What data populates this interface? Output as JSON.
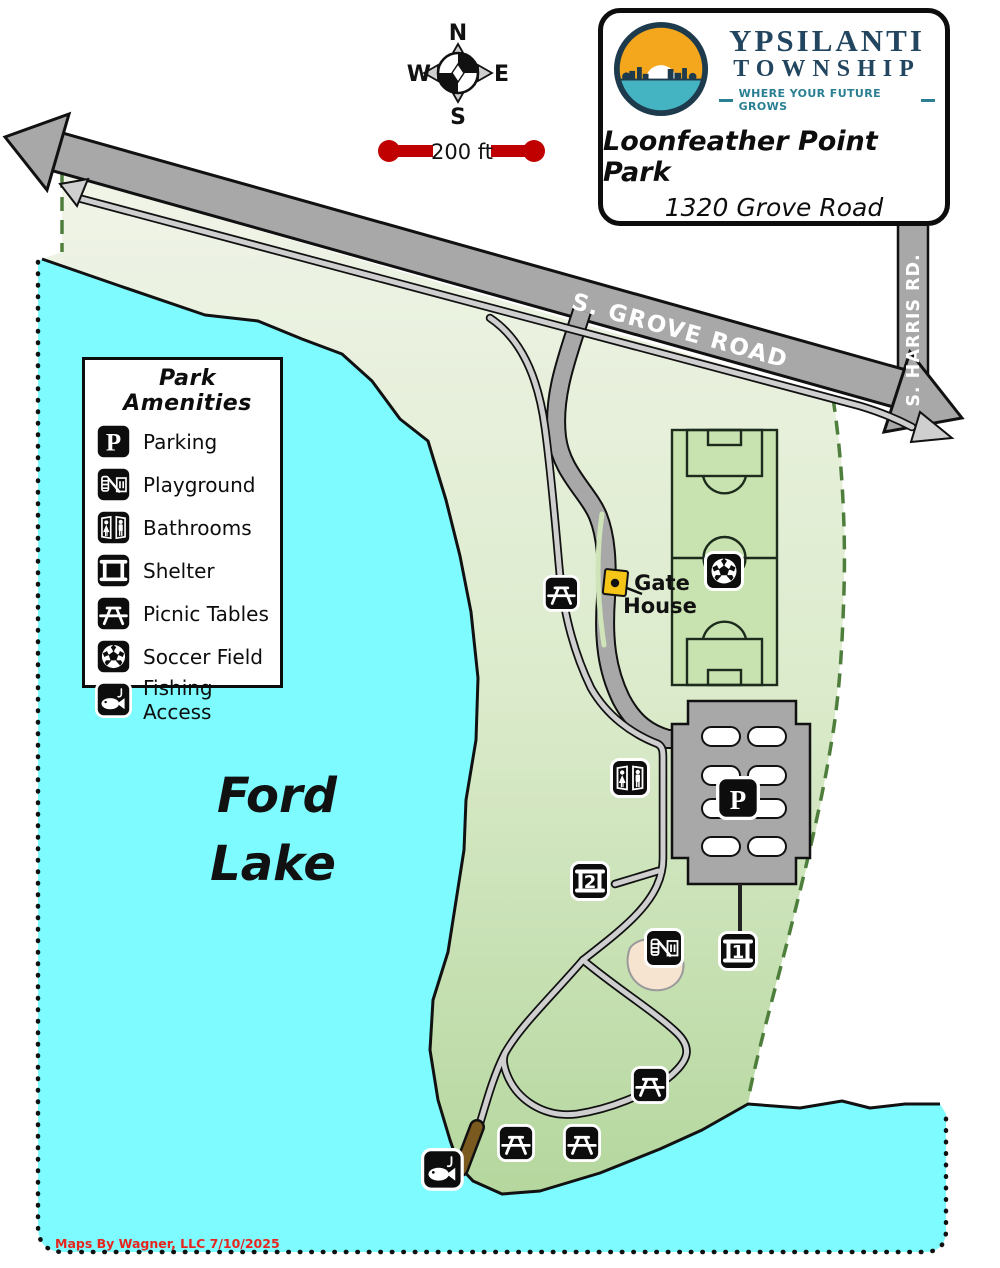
{
  "title_card": {
    "org_line1": "YPSILANTI",
    "org_line2": "TOWNSHIP",
    "tagline": "WHERE YOUR FUTURE GROWS",
    "park_name": "Loonfeather Point Park",
    "address": "1320 Grove Road"
  },
  "compass": {
    "n": "N",
    "s": "S",
    "e": "E",
    "w": "W"
  },
  "scale": {
    "label": "200 ft"
  },
  "legend": {
    "title": "Park Amenities",
    "items": [
      {
        "icon": "parking-icon",
        "label": "Parking"
      },
      {
        "icon": "playground-icon",
        "label": "Playground"
      },
      {
        "icon": "bathrooms-icon",
        "label": "Bathrooms"
      },
      {
        "icon": "shelter-icon",
        "label": "Shelter"
      },
      {
        "icon": "picnic-icon",
        "label": "Picnic Tables"
      },
      {
        "icon": "soccer-icon",
        "label": "Soccer Field"
      },
      {
        "icon": "fishing-icon",
        "label": "Fishing Access"
      }
    ]
  },
  "map_labels": {
    "grove_road": "S. GROVE ROAD",
    "harris_road": "S. HARRIS RD.",
    "gate_line1": "Gate",
    "gate_line2": "House",
    "lake_line1": "Ford",
    "lake_line2": "Lake",
    "shelter1_num": "1",
    "shelter2_num": "2",
    "parking_letter": "P"
  },
  "credit": {
    "text": "Maps By Wagner, LLC  7/10/2025"
  },
  "colors": {
    "lake": "#7DFBFF",
    "park_top": "#F0F4E8",
    "park_mid": "#DCEBCC",
    "park_bottom": "#B5D79E",
    "road_gray": "#A8A8A8",
    "trail_gray": "#CFCFCF",
    "boundary_green": "#4E7E3C",
    "scale_red": "#C00000",
    "gatehouse_yellow": "#F5C518",
    "pier_brown": "#7A5A1E",
    "playground_sand": "#F6E3D0",
    "credit_red": "#E8241F",
    "logo_orange": "#F4A71D",
    "logo_teal": "#44B3C2",
    "logo_navy": "#1E3B4D"
  }
}
